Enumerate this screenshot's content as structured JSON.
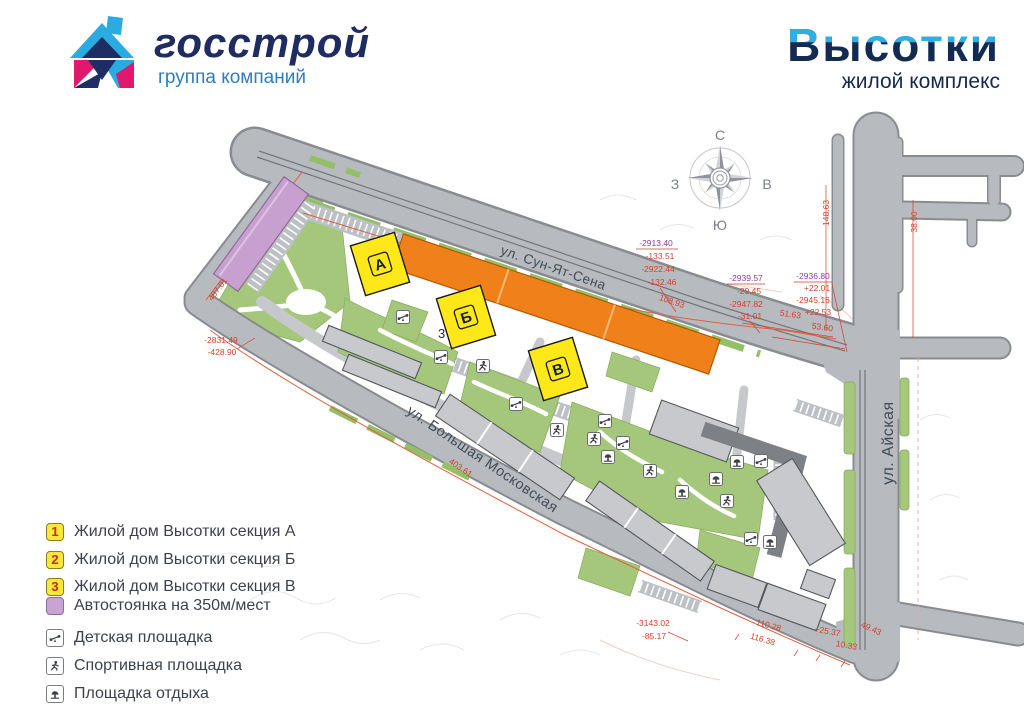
{
  "header": {
    "brand": {
      "name": "госстрой",
      "tagline": "группа компаний"
    },
    "project": {
      "name": "Высотки",
      "tagline": "жилой комплекс"
    }
  },
  "map": {
    "streets": {
      "sun_yat_sen": "ул. Сун-Ят-Сена",
      "bolshaya_moskovskaya": "ул. Большая Московская",
      "ayskaya": "ул. Айская"
    },
    "compass": {
      "north": "С",
      "south": "Ю",
      "west": "З",
      "east": "В"
    },
    "buildings": [
      {
        "label": "А"
      },
      {
        "label": "Б"
      },
      {
        "label": "В"
      }
    ],
    "site_number": "3",
    "annotations": [
      {
        "text": "-2913.40",
        "color": "#8e3a9e"
      },
      {
        "text": "-133.51",
        "color": "#d8402a"
      },
      {
        "text": "-2922.44",
        "color": "#d8402a"
      },
      {
        "text": "-132.46",
        "color": "#d8402a"
      },
      {
        "text": "-2939.57",
        "color": "#8e3a9e"
      },
      {
        "text": "-29.45",
        "color": "#d8402a"
      },
      {
        "text": "-2947.82",
        "color": "#d8402a"
      },
      {
        "text": "-31.01",
        "color": "#d8402a"
      },
      {
        "text": "-2936.80",
        "color": "#8e3a9e"
      },
      {
        "text": "+22.01",
        "color": "#d8402a"
      },
      {
        "text": "-2945.16",
        "color": "#d8402a"
      },
      {
        "text": "+22.53",
        "color": "#d8402a"
      },
      {
        "text": "108.93",
        "color": "#d8402a"
      },
      {
        "text": "51.63",
        "color": "#d8402a"
      },
      {
        "text": "53.60",
        "color": "#d8402a"
      },
      {
        "text": "-2831.49",
        "color": "#d8402a"
      },
      {
        "text": "-428.90",
        "color": "#d8402a"
      },
      {
        "text": "407.01",
        "color": "#d8402a"
      },
      {
        "text": "403.61",
        "color": "#d8402a"
      },
      {
        "text": "-3143.02",
        "color": "#d8402a"
      },
      {
        "text": "-85.17",
        "color": "#d8402a"
      },
      {
        "text": "110.28",
        "color": "#d8402a"
      },
      {
        "text": "116.38",
        "color": "#d8402a"
      },
      {
        "text": "+25.37",
        "color": "#d8402a"
      },
      {
        "text": "10.33",
        "color": "#d8402a"
      },
      {
        "text": "49.43",
        "color": "#d8402a"
      },
      {
        "text": "148.63",
        "color": "#d8402a"
      },
      {
        "text": "38.00",
        "color": "#d8402a"
      }
    ]
  },
  "legend": {
    "items": [
      {
        "key": "1",
        "label": "Жилой дом Высотки секция А"
      },
      {
        "key": "2",
        "label": "Жилой дом Высотки секция Б"
      },
      {
        "key": "3",
        "label": "Жилой дом Высотки секция В"
      },
      {
        "key": "",
        "label": "Автостоянка на 350м/мест"
      },
      {
        "key": "",
        "label": "Детская площадка"
      },
      {
        "key": "",
        "label": "Спортивная площадка"
      },
      {
        "key": "",
        "label": "Площадка отдыха"
      }
    ]
  },
  "colors": {
    "orange_building": "#f08019",
    "yellow_building": "#ffe81a",
    "parking_purple": "#c8a0d0",
    "lawn_green": "#a5c77b",
    "road_gray": "#b7babe",
    "boundary_red": "#e0603f",
    "annotation_red": "#d8402a",
    "annotation_purple": "#8e3a9e"
  }
}
